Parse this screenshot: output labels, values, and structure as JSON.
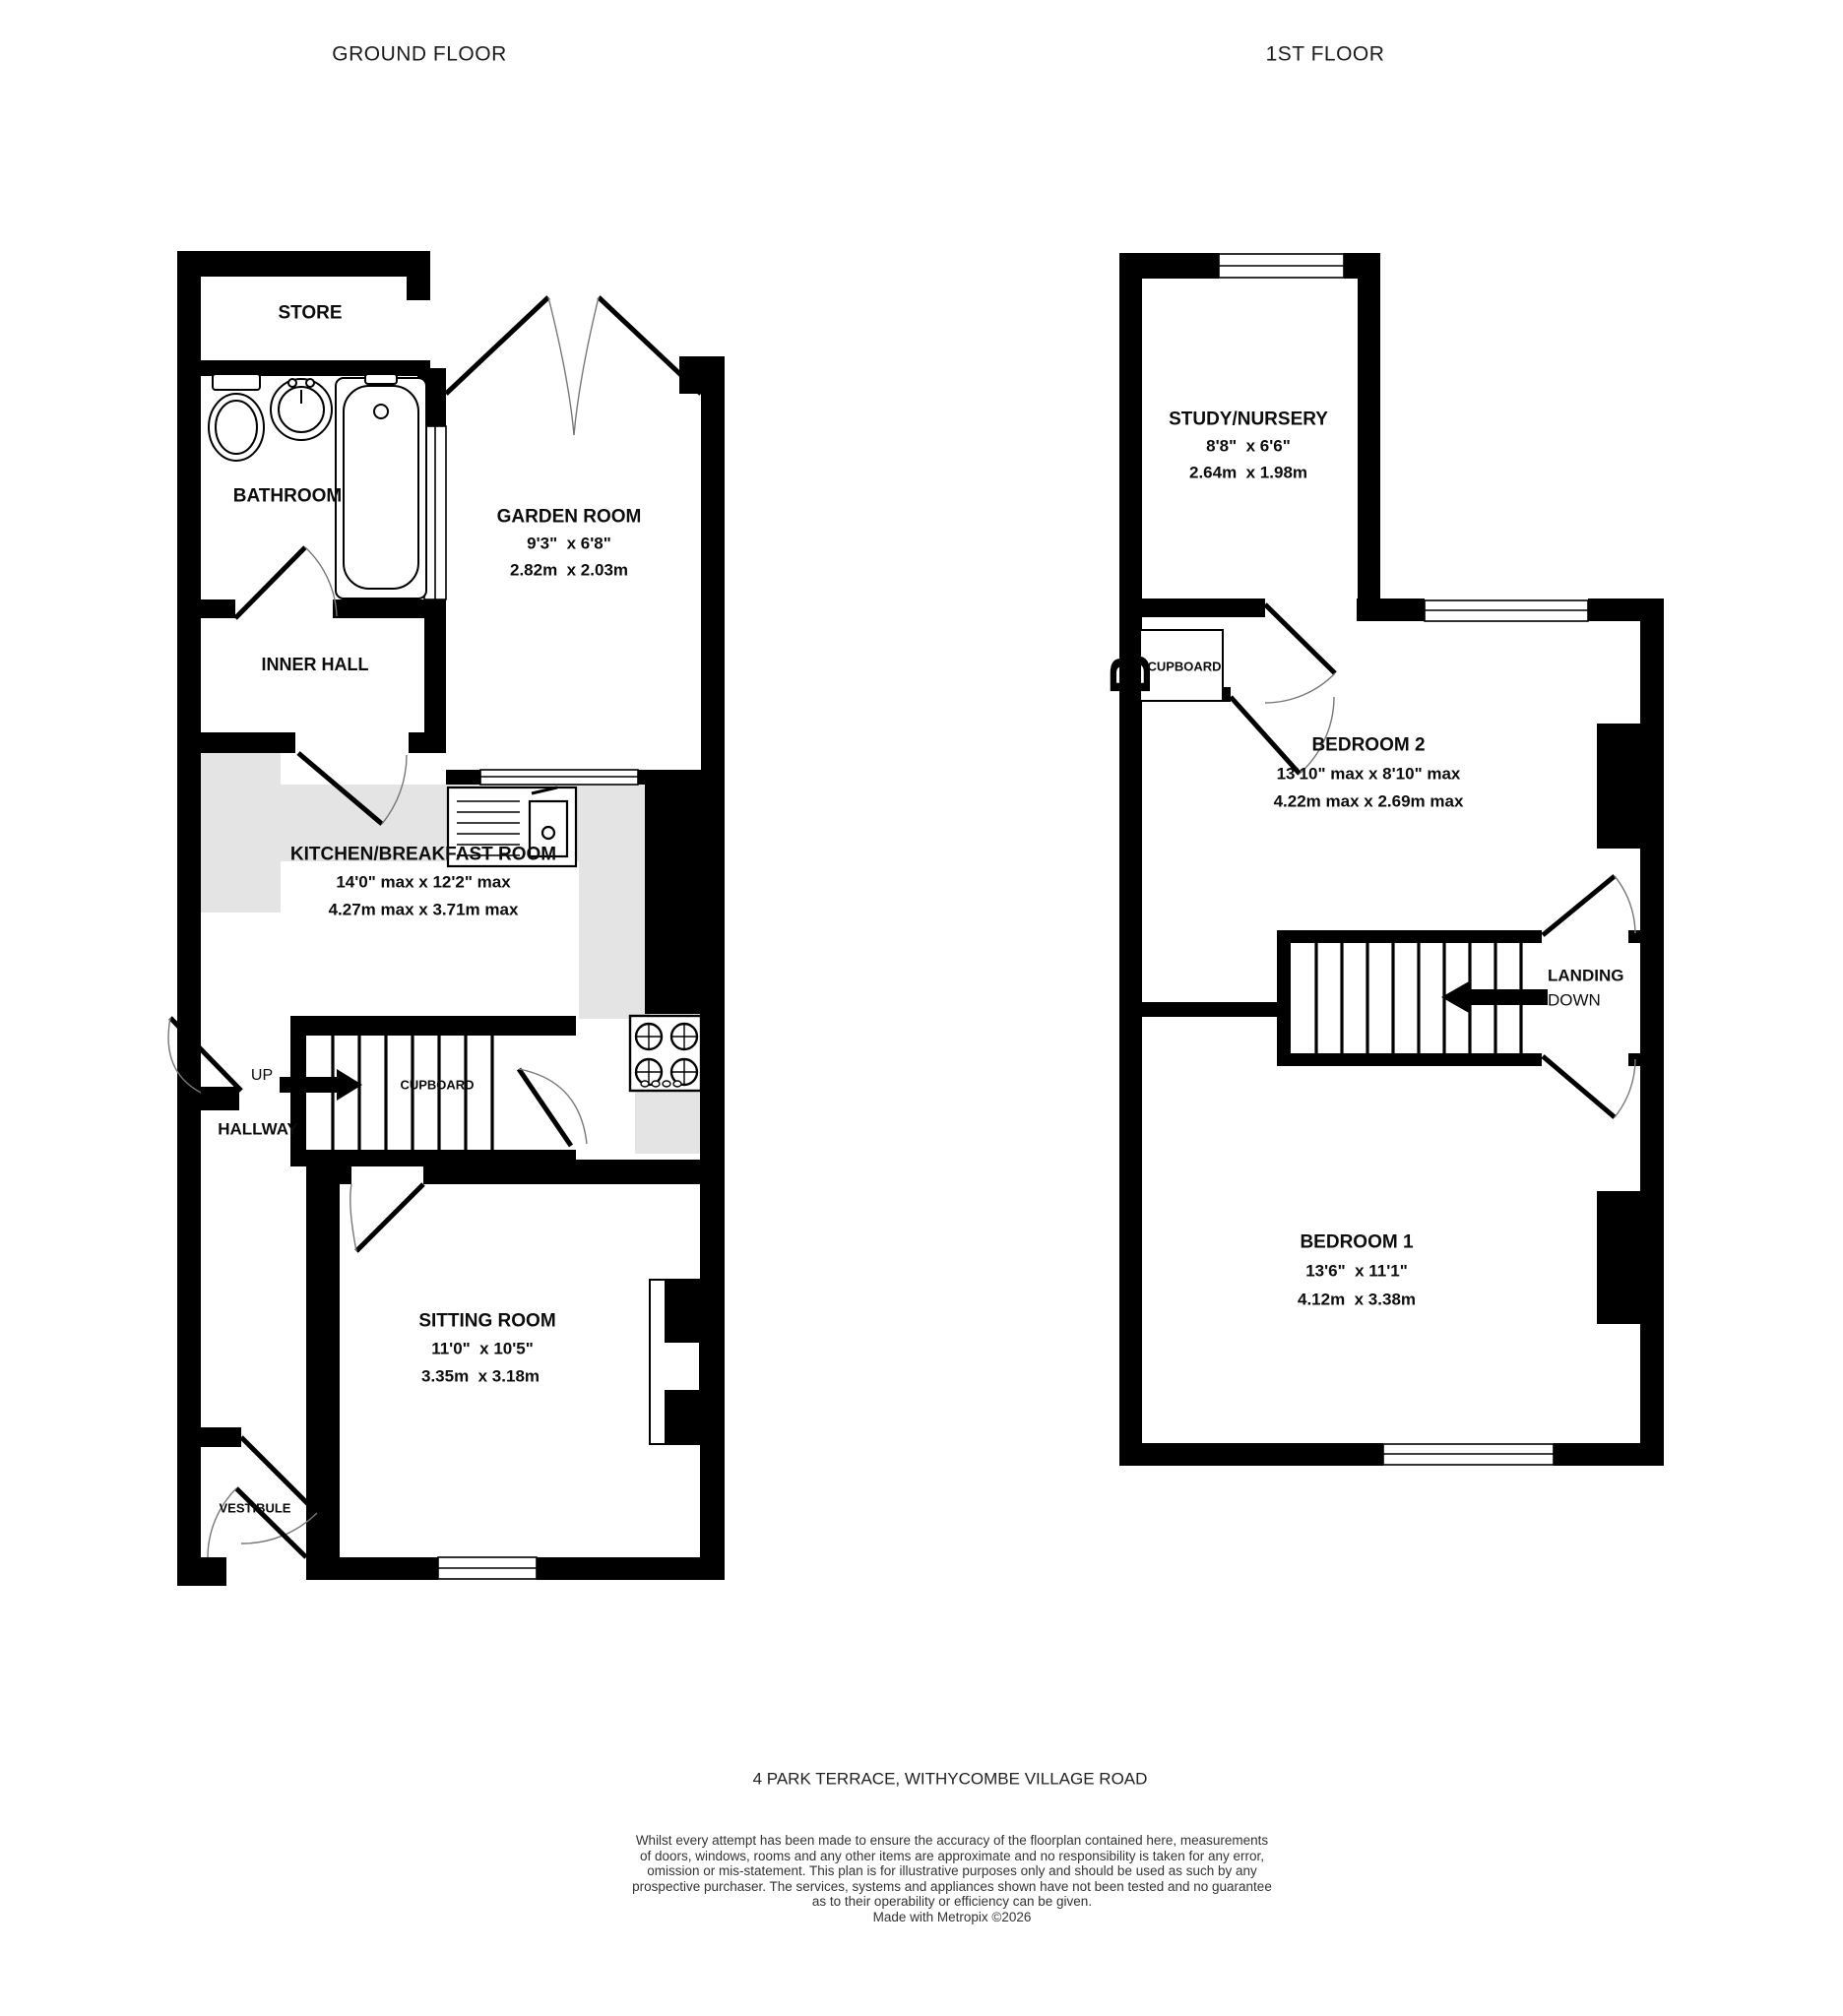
{
  "titles": {
    "ground_floor": "GROUND FLOOR",
    "first_floor": "1ST FLOOR"
  },
  "ground_floor": {
    "store": {
      "name": "STORE"
    },
    "bathroom": {
      "name": "BATHROOM"
    },
    "garden_room": {
      "name": "GARDEN ROOM",
      "imperial": "9'3\"  x 6'8\"",
      "metric": "2.82m  x 2.03m"
    },
    "inner_hall": {
      "name": "INNER HALL"
    },
    "kitchen": {
      "name": "KITCHEN/BREAKFAST ROOM",
      "imperial": "14'0\" max x 12'2\" max",
      "metric": "4.27m max x 3.71m max"
    },
    "up_label": "UP",
    "cupboard_label": "CUPBOARD",
    "hallway": {
      "name": "HALLWAY"
    },
    "sitting_room": {
      "name": "SITTING ROOM",
      "imperial": "11'0\"  x 10'5\"",
      "metric": "3.35m  x 3.18m"
    },
    "vestibule": {
      "name": "VESTIBULE"
    }
  },
  "first_floor": {
    "study": {
      "name": "STUDY/NURSERY",
      "imperial": "8'8\"  x 6'6\"",
      "metric": "2.64m  x 1.98m"
    },
    "cupboard_label": "CUPBOARD",
    "bedroom2": {
      "name": "BEDROOM 2",
      "imperial": "13'10\" max x 8'10\" max",
      "metric": "4.22m max x 2.69m max"
    },
    "landing_label": "LANDING",
    "down_label": "DOWN",
    "bedroom1": {
      "name": "BEDROOM 1",
      "imperial": "13'6\"  x 11'1\"",
      "metric": "4.12m  x 3.38m"
    }
  },
  "footer": {
    "address": "4 PARK TERRACE, WITHYCOMBE VILLAGE ROAD",
    "disclaimer_lines": [
      "Whilst every attempt has been made to ensure the accuracy of the floorplan contained here, measurements",
      "of doors, windows, rooms and any other items are approximate and no responsibility is taken for any error,",
      "omission or mis-statement. This plan is for illustrative purposes only and should be used as such by any",
      "prospective purchaser. The services, systems and appliances shown have not been tested and no guarantee",
      "as to their operability or efficiency can be given.",
      "Made with Metropix ©2026"
    ]
  },
  "colors": {
    "wall": "#000000",
    "counter": "#e4e4e4",
    "arc": "#777777"
  }
}
